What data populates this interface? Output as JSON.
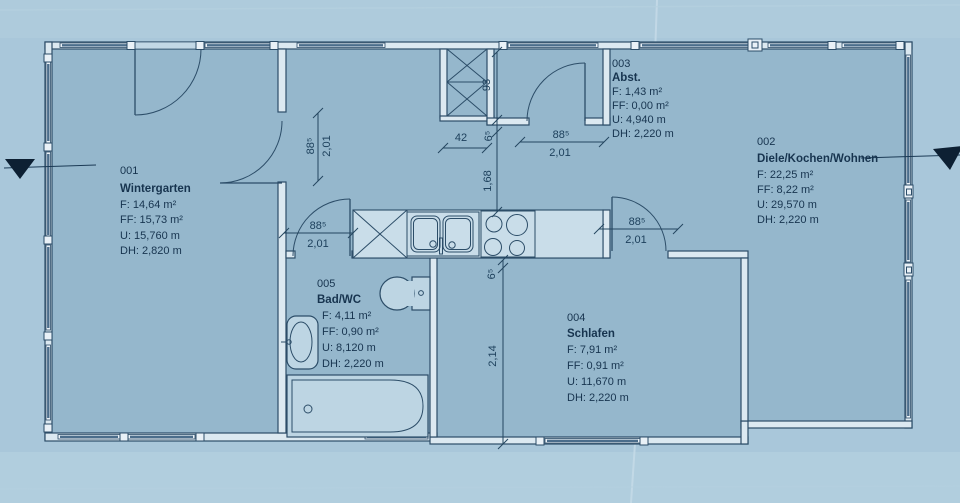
{
  "rooms": [
    {
      "id": "001",
      "name": "Wintergarten",
      "area": "F: 14,64 m²",
      "ff": "FF: 15,73 m²",
      "u": "U: 15,760 m",
      "dh": "DH: 2,820 m"
    },
    {
      "id": "002",
      "name": "Diele/Kochen/Wohnen",
      "area": "F: 22,25 m²",
      "ff": "FF: 8,22 m²",
      "u": "U: 29,570 m",
      "dh": "DH: 2,220 m"
    },
    {
      "id": "003",
      "name": "Abst.",
      "area": "F: 1,43 m²",
      "ff": "FF: 0,00 m²",
      "u": "U: 4,940 m",
      "dh": "DH: 2,220 m"
    },
    {
      "id": "004",
      "name": "Schlafen",
      "area": "F: 7,91 m²",
      "ff": "FF: 0,91 m²",
      "u": "U: 11,670 m",
      "dh": "DH: 2,220 m"
    },
    {
      "id": "005",
      "name": "Bad/WC",
      "area": "F: 4,11 m²",
      "ff": "FF: 0,90 m²",
      "u": "U: 8,120 m",
      "dh": "DH: 2,220 m"
    }
  ],
  "dims": {
    "door_w": "88⁵",
    "door_h": "2,01",
    "w42": "42",
    "h93": "93",
    "t65": "6⁵",
    "v168": "1,68",
    "v214": "2,14"
  },
  "colors": {
    "paper": "#a9c7da",
    "floor": "#95b7cc",
    "wall_fill": "#dce9f1",
    "line": "#2c4d68",
    "text": "#17344f",
    "marker": "#0d2033"
  }
}
